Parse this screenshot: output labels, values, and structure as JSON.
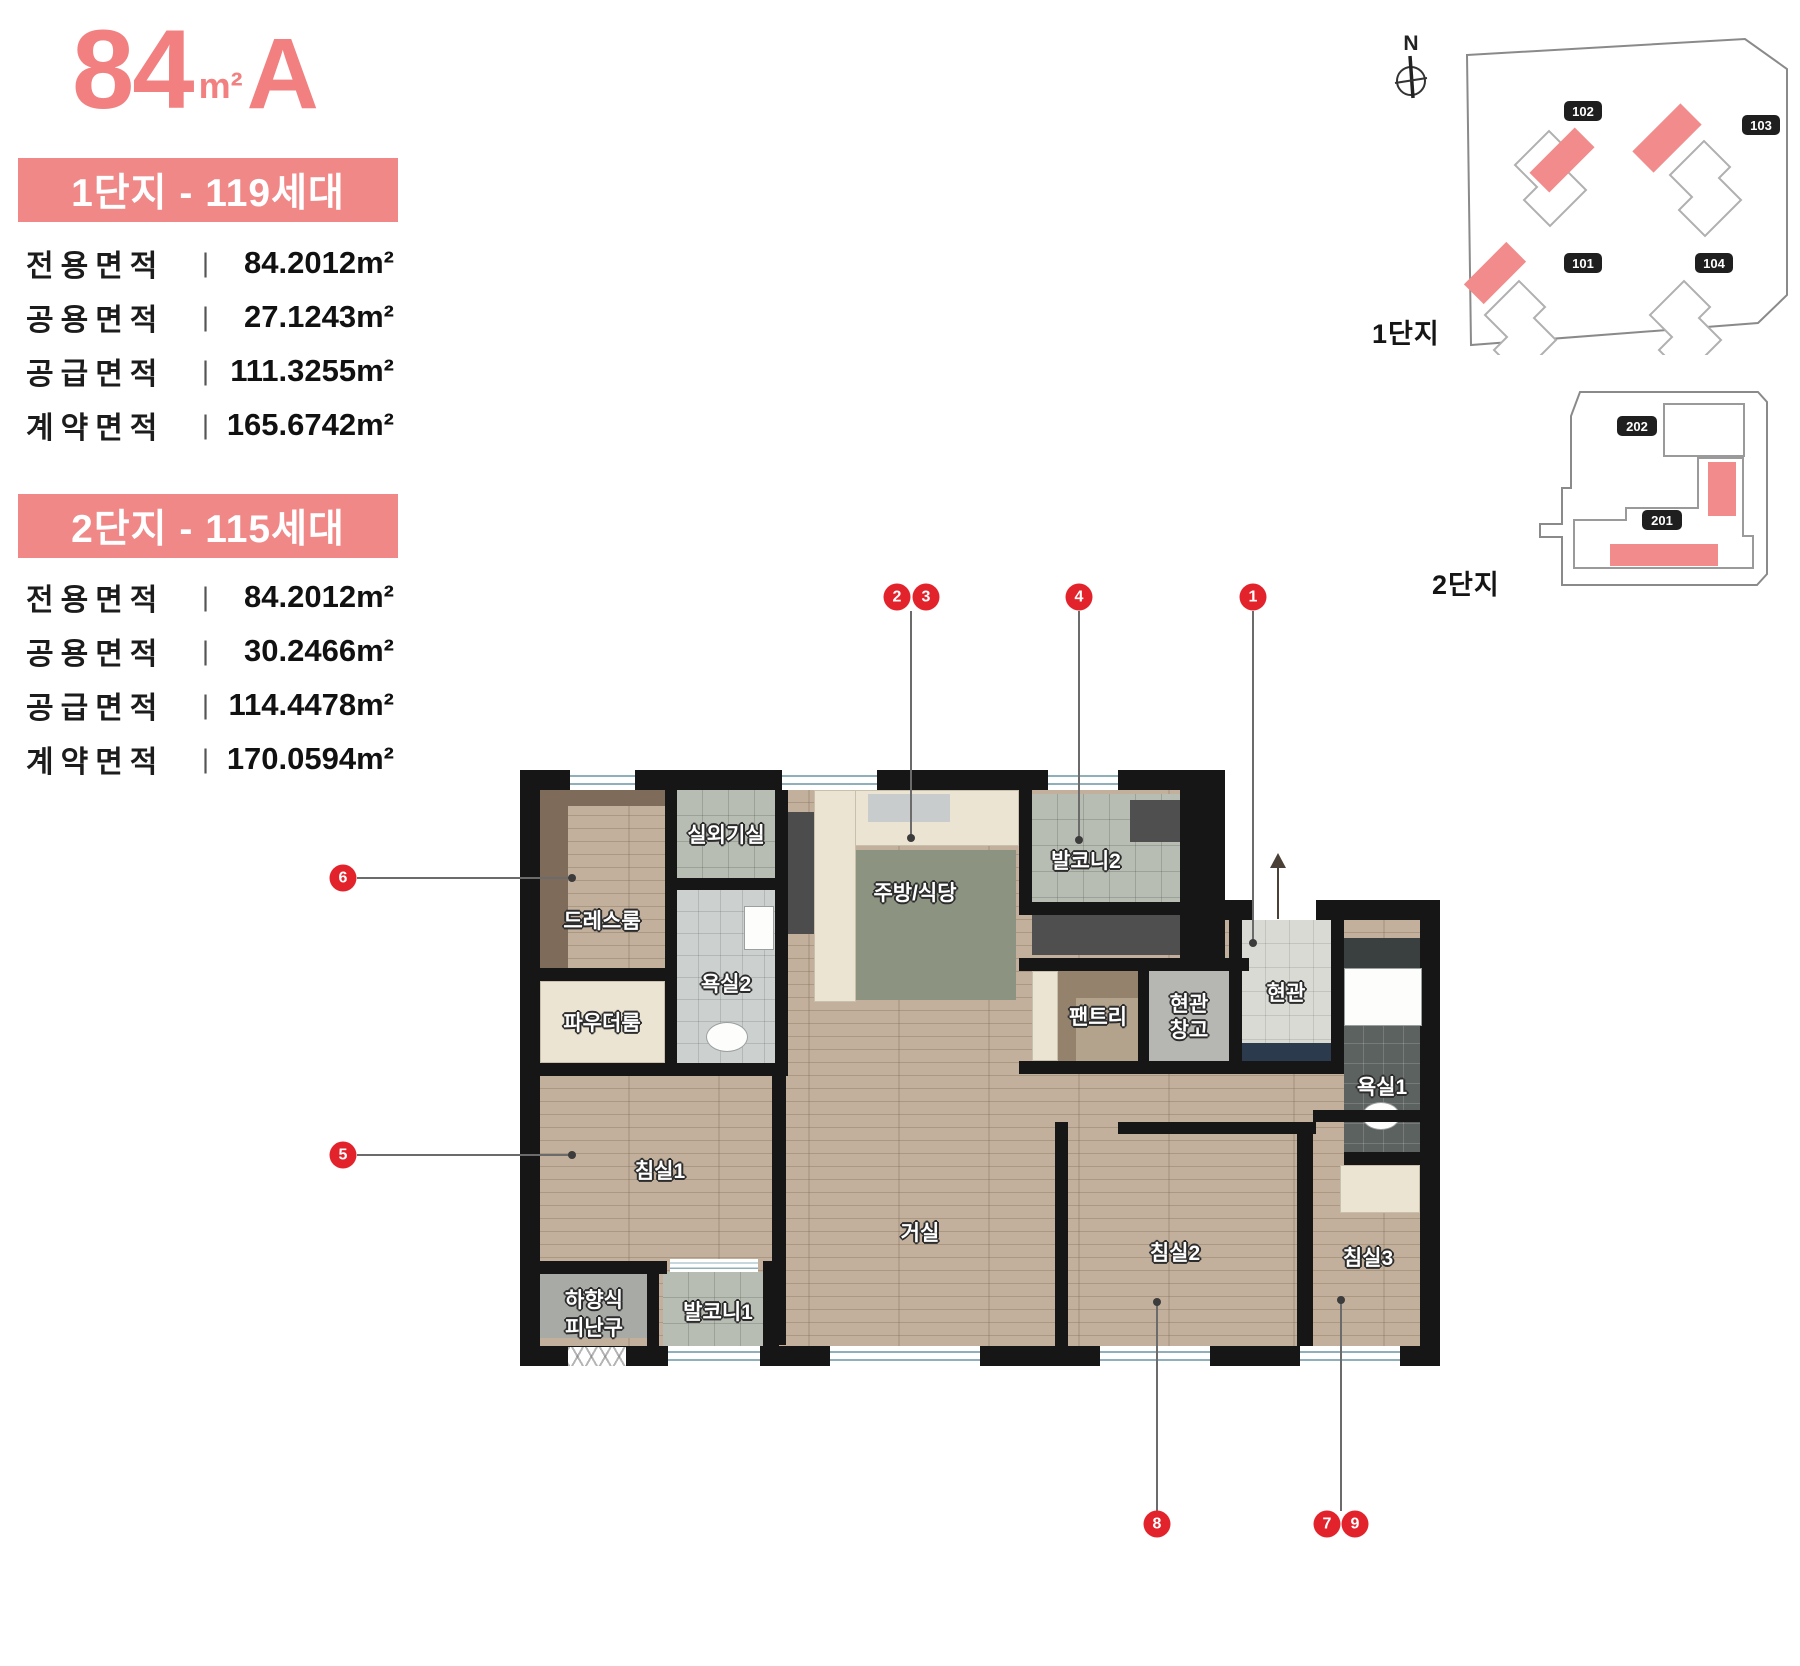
{
  "ui": {
    "divider": "|"
  },
  "title": {
    "num": "84",
    "unit": "m²",
    "type": "A"
  },
  "complex1": {
    "banner": "1단지 - 119세대",
    "rows": [
      {
        "label": "전용면적",
        "value": "84.2012m²"
      },
      {
        "label": "공용면적",
        "value": "27.1243m²"
      },
      {
        "label": "공급면적",
        "value": "111.3255m²"
      },
      {
        "label": "계약면적",
        "value": "165.6742m²"
      }
    ]
  },
  "complex2": {
    "banner": "2단지 - 115세대",
    "rows": [
      {
        "label": "전용면적",
        "value": "84.2012m²"
      },
      {
        "label": "공용면적",
        "value": "30.2466m²"
      },
      {
        "label": "공급면적",
        "value": "114.4478m²"
      },
      {
        "label": "계약면적",
        "value": "170.0594m²"
      }
    ]
  },
  "siteplans": {
    "compass": "N",
    "site1": {
      "label": "1단지",
      "buildings": [
        "102",
        "103",
        "101",
        "104"
      ]
    },
    "site2": {
      "label": "2단지",
      "buildings": [
        "202",
        "201"
      ]
    }
  },
  "floorplan": {
    "rooms": {
      "outdoor_unit": "실외기실",
      "dressroom": "드레스룸",
      "powder_room": "파우더룸",
      "bathroom2": "욕실2",
      "kitchen_dining": "주방/식당",
      "balcony2": "발코니2",
      "pantry": "팬트리",
      "entry_storage_line1": "현관",
      "entry_storage_line2": "창고",
      "entrance": "현관",
      "bathroom1": "욕실1",
      "bedroom1": "침실1",
      "living_room": "거실",
      "bedroom2": "침실2",
      "bedroom3": "침실3",
      "escape_hatch_line1": "하향식",
      "escape_hatch_line2": "피난구",
      "balcony1": "발코니1"
    }
  },
  "markers": [
    "1",
    "2",
    "3",
    "4",
    "5",
    "6",
    "7",
    "8",
    "9"
  ],
  "colors": {
    "accent_pink": "#f08888",
    "marker_red": "#e2232b",
    "wall_black": "#161616"
  }
}
